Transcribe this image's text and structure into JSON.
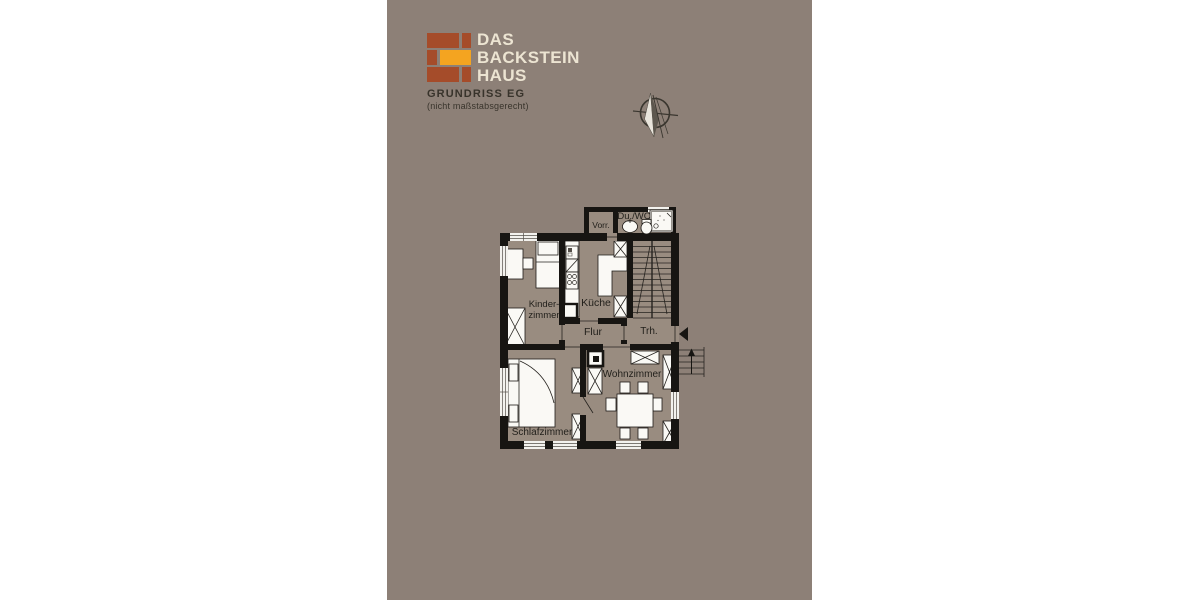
{
  "brand": {
    "name_line1": "DAS",
    "name_line2": "BACKSTEIN",
    "name_line3": "HAUS"
  },
  "header": {
    "title": "GRUNDRISS EG",
    "subtitle": "(nicht maßstabsgerecht)"
  },
  "floorplan": {
    "rooms": {
      "vorraum": "Vorr.",
      "shower_wc": "Du./WC",
      "kids_room_line1": "Kinder-",
      "kids_room_line2": "zimmer",
      "kitchen": "Küche",
      "hallway": "Flur",
      "staircase": "Trh.",
      "living_room": "Wohnzimmer",
      "bedroom": "Schlafzimmer"
    }
  },
  "icons": {
    "logo": "brick-logo",
    "compass": "north-arrow-compass",
    "entry": "entry-direction-arrow",
    "exterior_steps": "entrance-steps-up-arrow"
  },
  "colors": {
    "background": "#8d8077",
    "floor": "#998c80",
    "wall": "#171512",
    "brick_red": "#a54c2a",
    "brick_yellow": "#f4a420",
    "brand_text": "#ece4d2",
    "title_text": "#38332b",
    "label_text": "#211f1a"
  }
}
